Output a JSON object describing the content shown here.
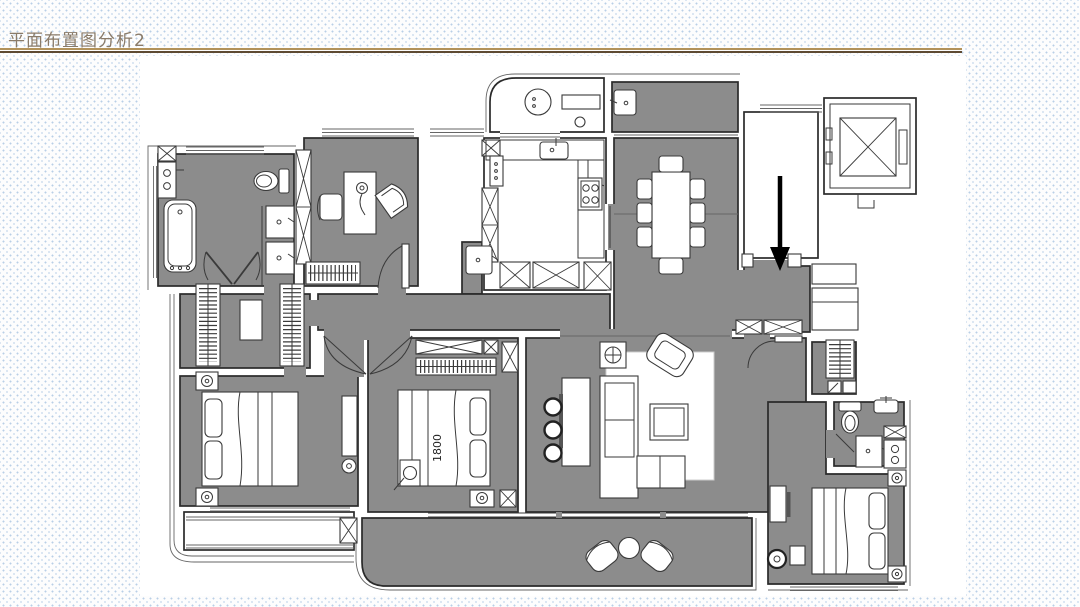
{
  "slide": {
    "title": "平面布置图分析2",
    "title_color": "#8a7b69",
    "divider": {
      "top_color": "#b2925a",
      "bottom_color": "#5e4a32"
    },
    "background": {
      "dot_color": "#b9cfe6",
      "canvas_color": "#ffffff"
    }
  },
  "floorplan": {
    "floor_color": "#8c8c8c",
    "wall_line_color": "#2a2a2a",
    "bed_size_label": "1800",
    "entry_arrow": {
      "color": "#000000",
      "direction": "down"
    }
  }
}
